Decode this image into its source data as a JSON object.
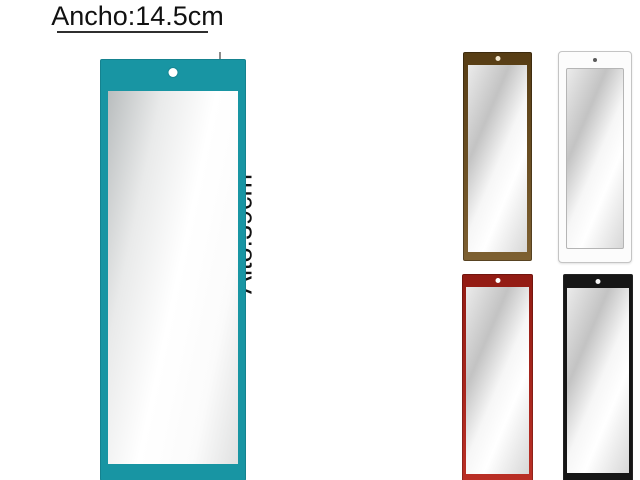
{
  "image": {
    "background": "#ffffff",
    "kind": "product photo of rectangular wall mirrors"
  },
  "annotations": {
    "width_label": "Ancho:14.5cm",
    "height_label": "Alto:39cm",
    "text_color": "#111111",
    "underline_color": "#2f2f2f",
    "height_line_color": "#8c8c8c"
  },
  "main_mirror": {
    "label": "teal framed mirror",
    "frame_color": "#1895a3",
    "hole_color": "#ffffff"
  },
  "variants": [
    {
      "label": "brown framed mirror",
      "frame_color": "#6f4e1a",
      "hole_color": "#f2e7cf"
    },
    {
      "label": "white framed mirror",
      "frame_color": "#fcfcfc",
      "border_color": "#c4c4c4",
      "hole_color": "#5a5a5a"
    },
    {
      "label": "red framed mirror",
      "frame_color": "#b62218",
      "hole_color": "#ffffff"
    },
    {
      "label": "black framed mirror",
      "frame_color": "#161616",
      "hole_color": "#f5f5f5"
    }
  ]
}
